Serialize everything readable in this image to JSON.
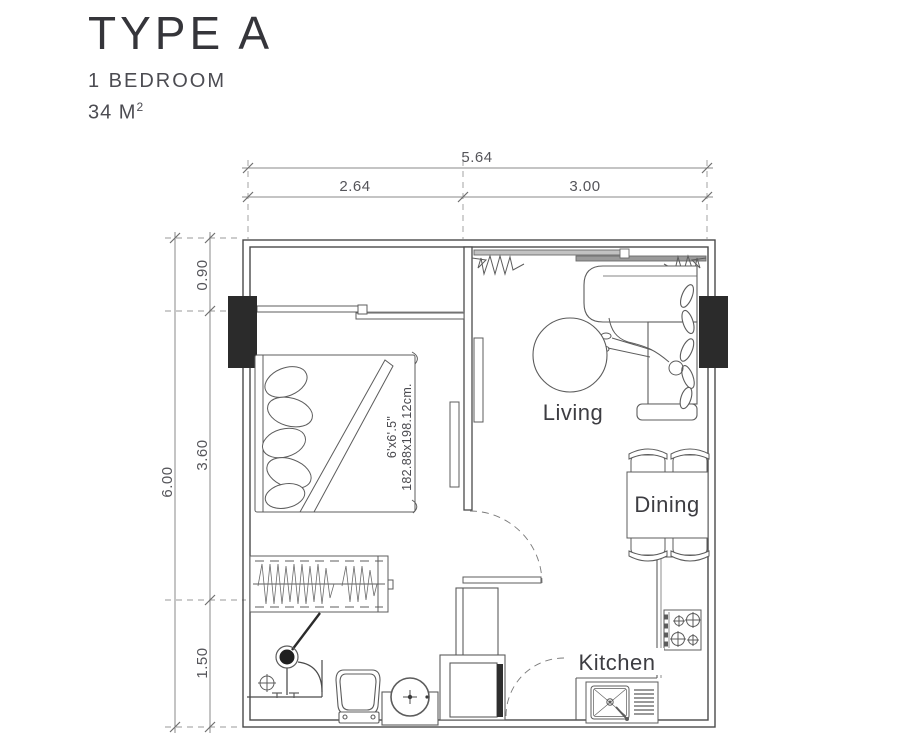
{
  "title_block": {
    "type": "TYPE A",
    "subtitle": "1 BEDROOM",
    "area_value": "34 M",
    "area_exponent": "2"
  },
  "dimensions": {
    "total_width": "5.64",
    "width_left": "2.64",
    "width_right": "3.00",
    "total_height": "6.00",
    "height_top": "0.90",
    "height_middle": "3.60",
    "height_bottom": "1.50"
  },
  "rooms": {
    "living": "Living",
    "dining": "Dining",
    "kitchen": "Kitchen"
  },
  "bed": {
    "size_imperial": "6'x6'.5\"",
    "size_metric": "182.88x198.12cm."
  },
  "colors": {
    "wall": "#4a4a4a",
    "furniture_line": "#5c5c5c",
    "dimension_line": "#8a8a8a",
    "column_fill": "#2b2b2b",
    "glass_light": "#c2c2c2",
    "glass_dark": "#9a9a9a",
    "title_text": "#35353a",
    "label_text": "#3d3d42"
  }
}
